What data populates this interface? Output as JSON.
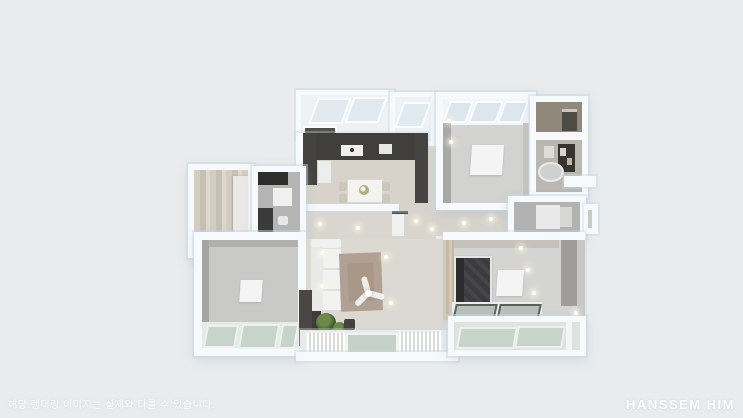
{
  "scene": {
    "type": "3d-floorplan-top-view",
    "background": "#e9ebec",
    "palette": {
      "wall_white": "#f7fafc",
      "wall_shadow_tint": "#cdd9e4",
      "floor_wood": "#d8d4cb",
      "floor_gray": "#cbccca",
      "entrance_marble": "#ccc5b9",
      "kitchen_counter_dark": "#413f3c",
      "bathroom_tile_dark": "#39332e",
      "balcony_glass_green": "#c6d4cb",
      "skylight_glass": "#e2eaf1",
      "bed_charcoal": "#3c3c3f",
      "living_rug_taupe": "#b1a194",
      "plant_green": "#44602f",
      "ceiling_light": "#fffdf2"
    },
    "rooms": [
      {
        "name": "entrance-hall"
      },
      {
        "name": "pantry-room"
      },
      {
        "name": "kitchen-dining"
      },
      {
        "name": "hallway"
      },
      {
        "name": "bedroom-top-right"
      },
      {
        "name": "utility-room"
      },
      {
        "name": "bathroom-main"
      },
      {
        "name": "bathroom-small"
      },
      {
        "name": "living-room"
      },
      {
        "name": "bedroom-left"
      },
      {
        "name": "master-bedroom"
      },
      {
        "name": "balcony-living"
      },
      {
        "name": "balcony-master"
      }
    ],
    "furniture": [
      "dining-table-with-chairs",
      "white-sofa-sectional",
      "area-rug",
      "ceiling-fan",
      "double-bed-dark-bedding",
      "bathtub",
      "washing-machine",
      "house-plants",
      "wardrobe",
      "white-floor-rugs",
      "recessed-ceiling-lights",
      "window-bays"
    ]
  },
  "overlay": {
    "disclaimer": "해당 렌더링 이미지는 실제와 다를 수 있습니다.",
    "watermark": "HANSSEM HIM"
  }
}
